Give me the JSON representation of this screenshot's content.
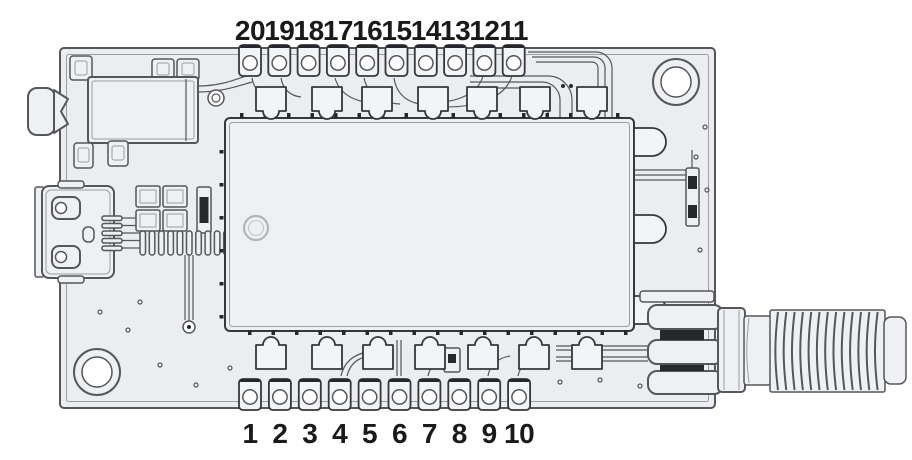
{
  "diagram": {
    "kind": "pcb-module-pinout",
    "components": [
      "audio-jack",
      "micro-usb-connector",
      "rf-shield-module",
      "pin1-marker",
      "sma-antenna-connector",
      "mounting-hole-top-right",
      "mounting-hole-bottom-left",
      "top-pin-row",
      "bottom-pin-row"
    ]
  },
  "pins": {
    "top": {
      "labels": [
        "20",
        "19",
        "18",
        "17",
        "16",
        "15",
        "14",
        "13",
        "12",
        "11"
      ]
    },
    "bottom": {
      "labels": [
        "1",
        "2",
        "3",
        "4",
        "5",
        "6",
        "7",
        "8",
        "9",
        "10"
      ]
    }
  },
  "colors": {
    "background": "#ffffff",
    "board_fill": "#ecedef",
    "part_fill": "#eff0f2",
    "pad_fill": "#f3f4f6",
    "hole_fill": "#ffffff",
    "line": "#55575b",
    "line_strong": "#35373b",
    "line_soft": "#9b9da1",
    "dark_accent": "#26282c",
    "ring_gray": "#b2b4b8",
    "label_text": "#1a1a1c"
  }
}
